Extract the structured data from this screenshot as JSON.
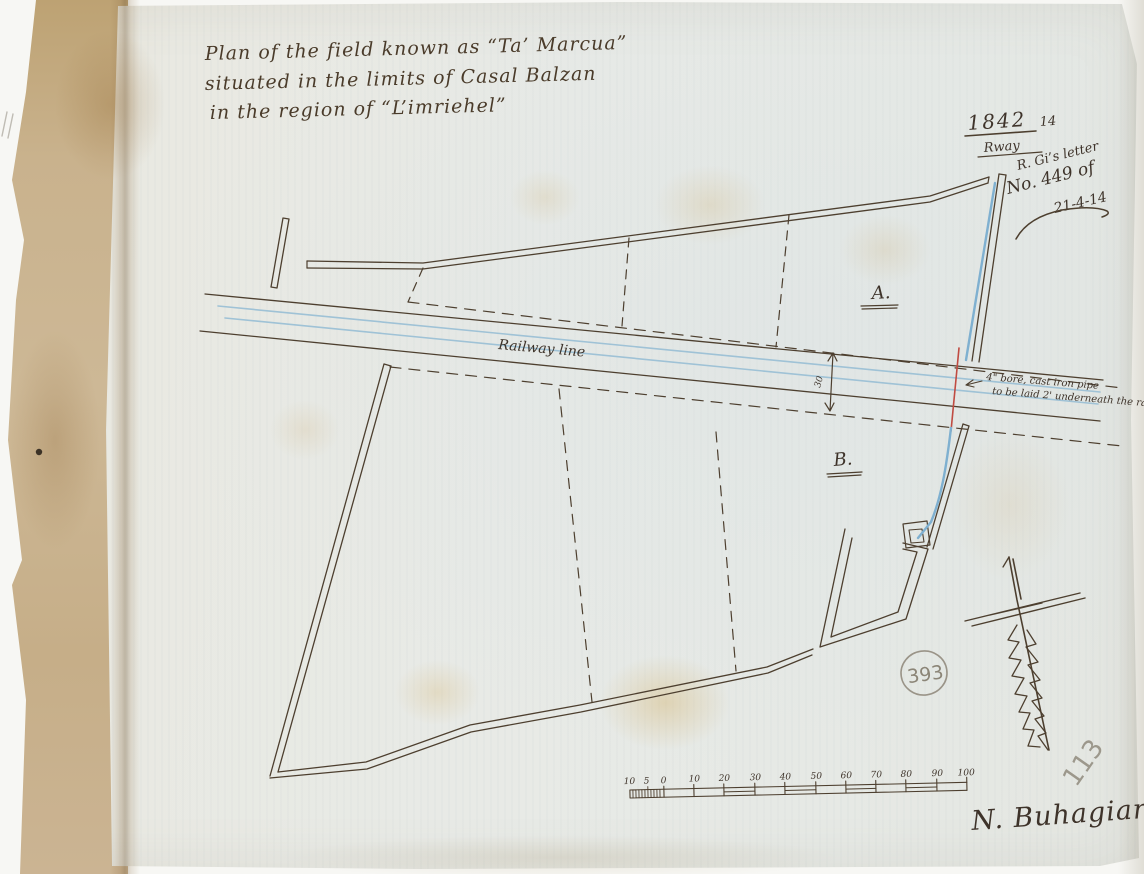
{
  "document": {
    "title_lines": [
      "Plan of the field known as “Ta’ Marcua”",
      "situated in the limits of Casal Balzan",
      "in the region of “L’imriehel”"
    ],
    "file_reference": {
      "year": "1842",
      "number": "14",
      "department": "Rway"
    },
    "letter_note": {
      "line1": "R. Gi’s letter",
      "line2": "No. 449 of",
      "line3": "21-4-14"
    },
    "labels": {
      "parcel_a": "A.",
      "parcel_b": "B.",
      "railway": "Railway line",
      "gauge_dimension": "30"
    },
    "pipe_note": {
      "line1": "4\" bore, cast iron pipe",
      "line2": "to be laid 2' underneath the rails"
    },
    "scale_bar": {
      "minor_labels": [
        "10",
        "5",
        "0"
      ],
      "major_labels": [
        "10",
        "20",
        "30",
        "40",
        "50",
        "60",
        "70",
        "80",
        "90",
        "100"
      ]
    },
    "registry_stamp": "393",
    "sheet_number": "113",
    "signature": "N. Buhagiar"
  },
  "colors": {
    "ink": "#4d3f2f",
    "pencil": "#8b8577",
    "railway_blue": "#9fc2d6",
    "pipe_blue": "#7fb0d0",
    "annotation_red": "#c04b42",
    "paper": "#e8eae5",
    "backing_paper": "#c7b08e"
  }
}
